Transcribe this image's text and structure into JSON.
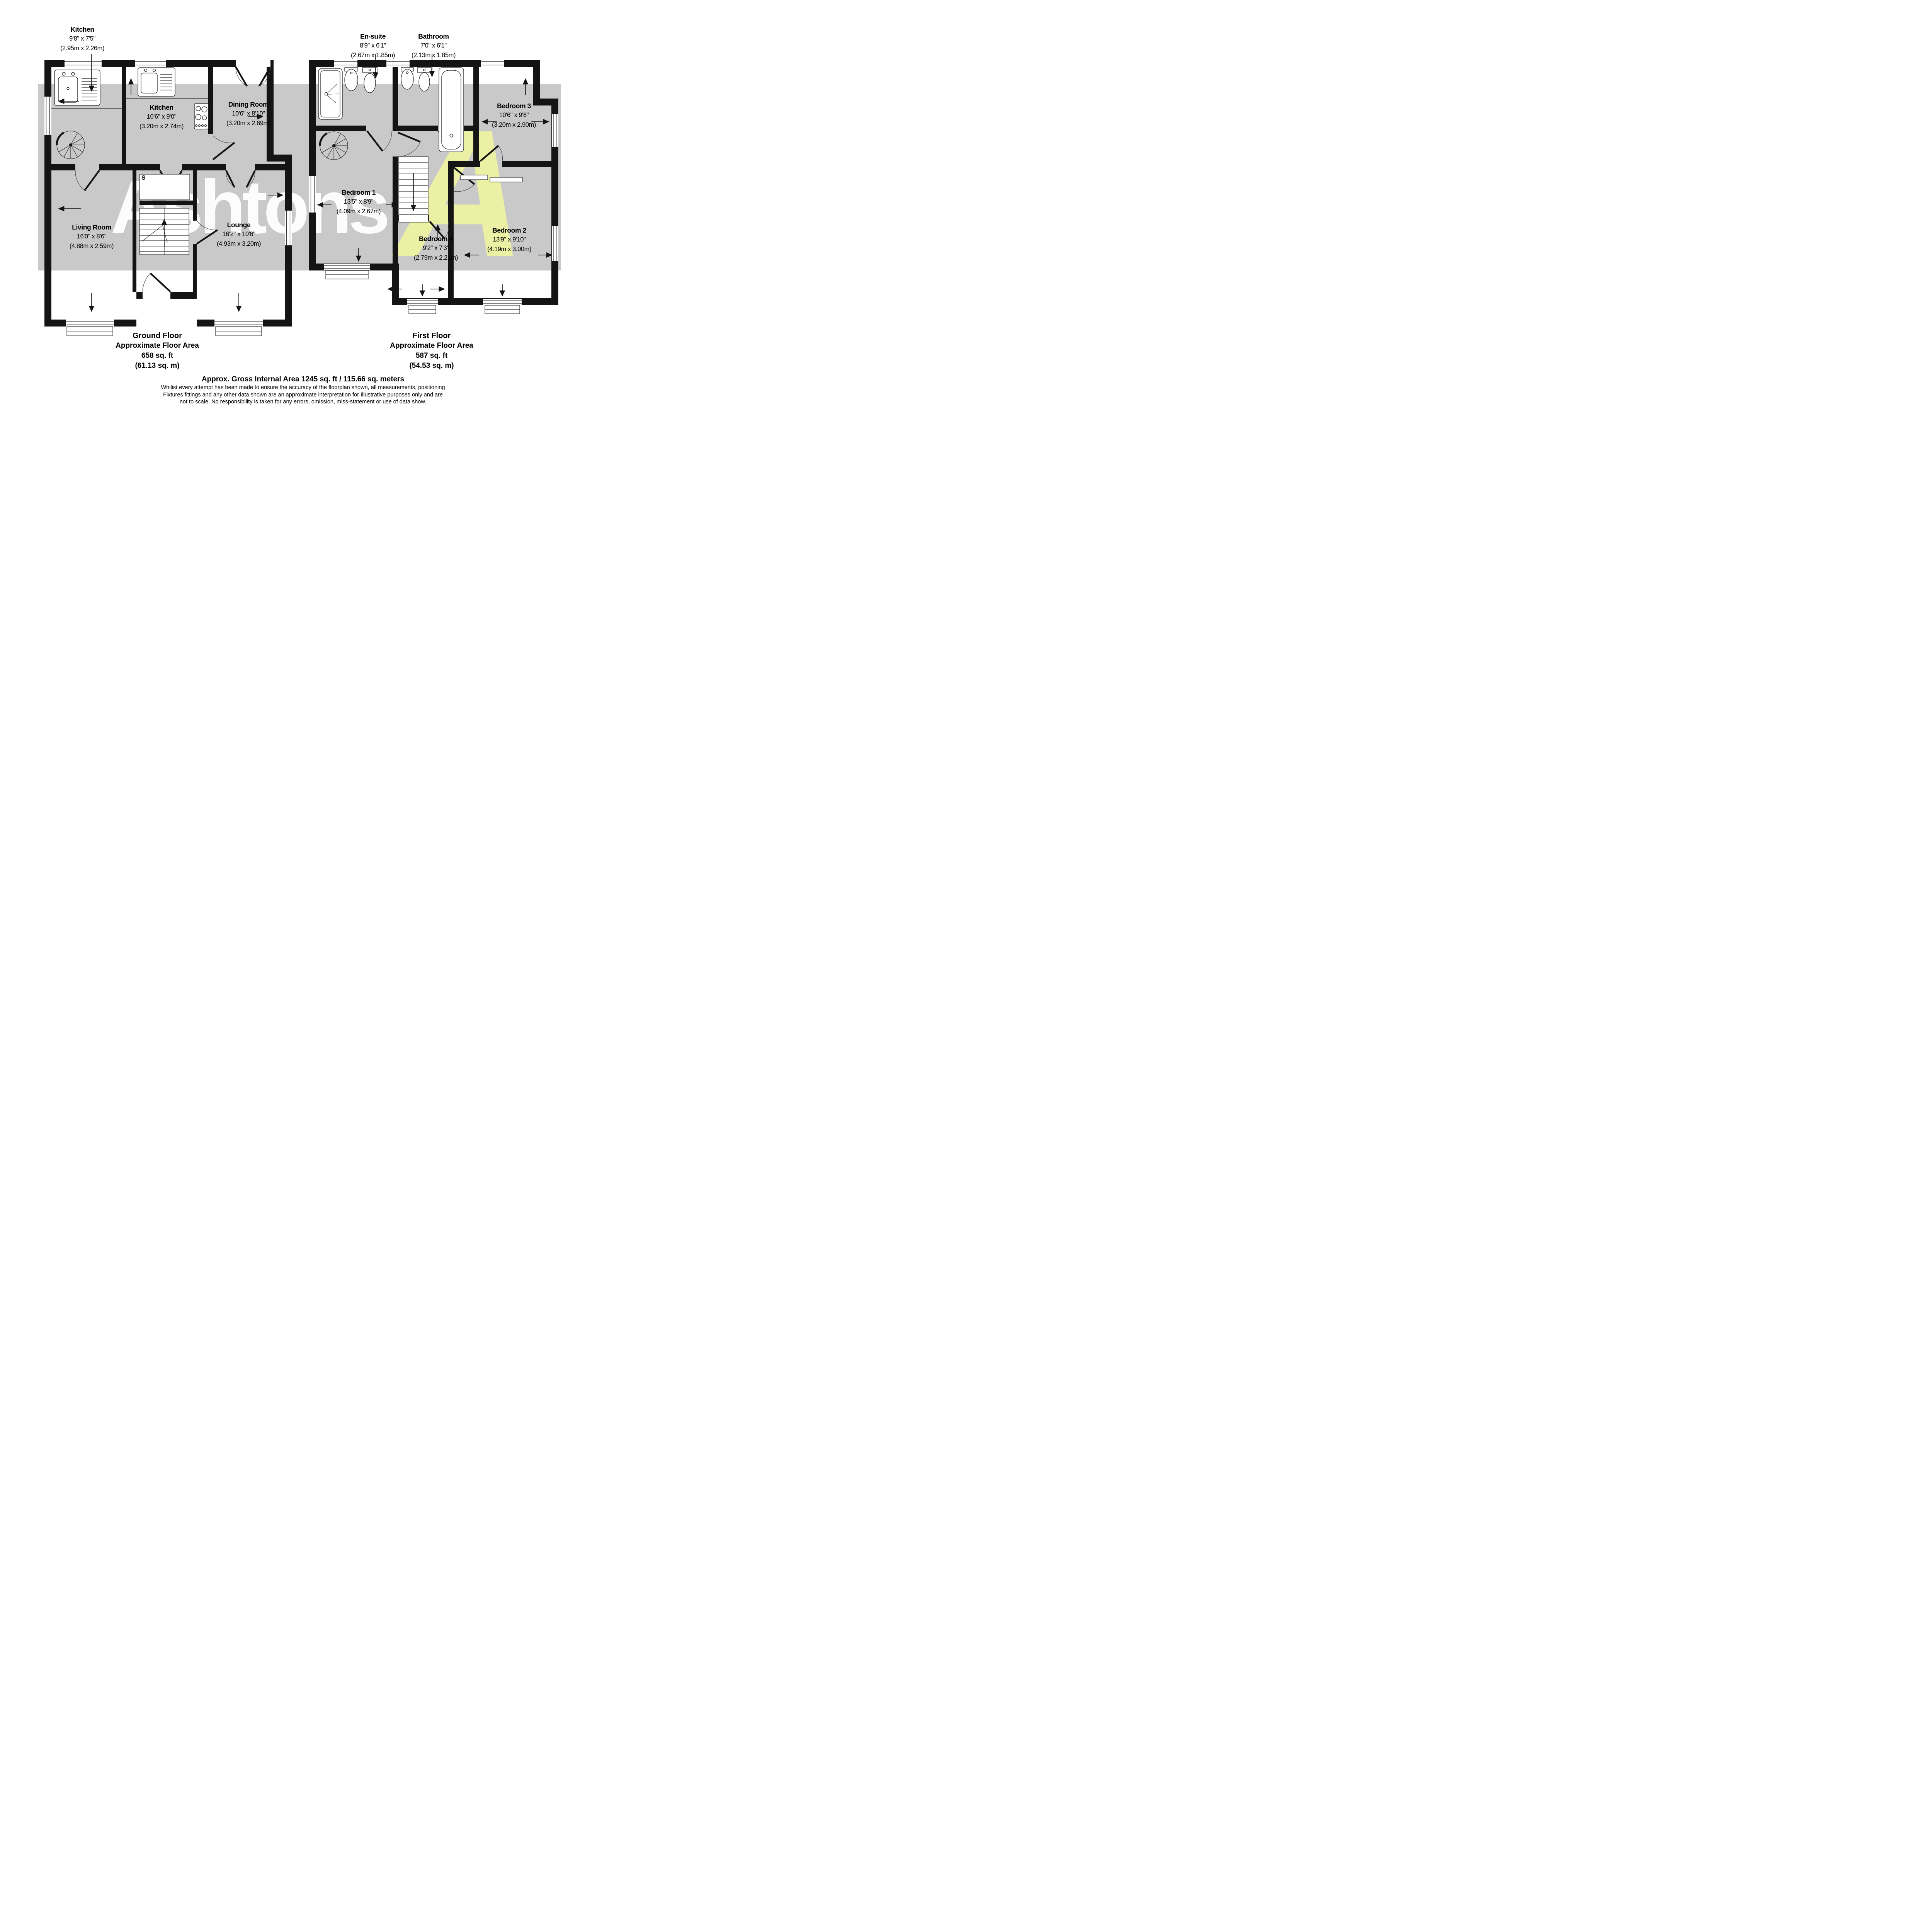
{
  "watermark": {
    "text": "Ashtons",
    "logo_letter": "A"
  },
  "colors": {
    "wall": "#141414",
    "floor_shade": "#c9c9c9",
    "watermark_yellow": "#edf3a3",
    "watermark_white": "#ffffff",
    "background": "#ffffff"
  },
  "ground_floor": {
    "rooms": [
      {
        "name": "Kitchen",
        "dims_imperial": "9'8\" x 7'5\"",
        "dims_metric": "(2.95m x 2.26m)"
      },
      {
        "name": "Kitchen",
        "dims_imperial": "10'6\" x 9'0\"",
        "dims_metric": "(3.20m x 2.74m)"
      },
      {
        "name": "Dining Room",
        "dims_imperial": "10'6\" x 8'10\"",
        "dims_metric": "(3.20m x 2.69m)"
      },
      {
        "name": "Living Room",
        "dims_imperial": "16'0\" x 8'6\"",
        "dims_metric": "(4.88m x 2.59m)"
      },
      {
        "name": "Lounge",
        "dims_imperial": "16'2\" x 10'6\"",
        "dims_metric": "(4.93m x 3.20m)"
      }
    ],
    "storage_label": "S",
    "footer": {
      "title": "Ground Floor",
      "line1": "Approximate Floor Area",
      "line2": "658 sq. ft",
      "line3": "(61.13 sq. m)"
    }
  },
  "first_floor": {
    "rooms": [
      {
        "name": "En-suite",
        "dims_imperial": "8'9\" x 6'1\"",
        "dims_metric": "(2.67m x 1.85m)"
      },
      {
        "name": "Bathroom",
        "dims_imperial": "7'0\" x 6'1\"",
        "dims_metric": "(2.13m x 1.85m)"
      },
      {
        "name": "Bedroom 3",
        "dims_imperial": "10'6\" x 9'6\"",
        "dims_metric": "(3.20m x 2.90m)"
      },
      {
        "name": "Bedroom 1",
        "dims_imperial": "13'5\" x 8'9\"",
        "dims_metric": "(4.09m x 2.67m)"
      },
      {
        "name": "Bedroom 4",
        "dims_imperial": "9'2\" x 7'3\"",
        "dims_metric": "(2.79m x 2.21m)"
      },
      {
        "name": "Bedroom 2",
        "dims_imperial": "13'9\" x 9'10\"",
        "dims_metric": "(4.19m x 3.00m)"
      }
    ],
    "footer": {
      "title": "First Floor",
      "line1": "Approximate Floor Area",
      "line2": "587 sq. ft",
      "line3": "(54.53 sq. m)"
    }
  },
  "summary": {
    "gross_area": "Approx. Gross Internal Area 1245 sq. ft / 115.66 sq. meters",
    "disclaimer_line1": "Whilist every attempt has been made to ensure the accuracy of the floorplan shown, all measurements, positioning",
    "disclaimer_line2": "Fixtures fittings and any other data shown are an approximate interpretation for Illustrative purposes only  and are",
    "disclaimer_line3": "not to scale. No responsibility is taken for any errors, omission, miss-statement or use of data show."
  }
}
